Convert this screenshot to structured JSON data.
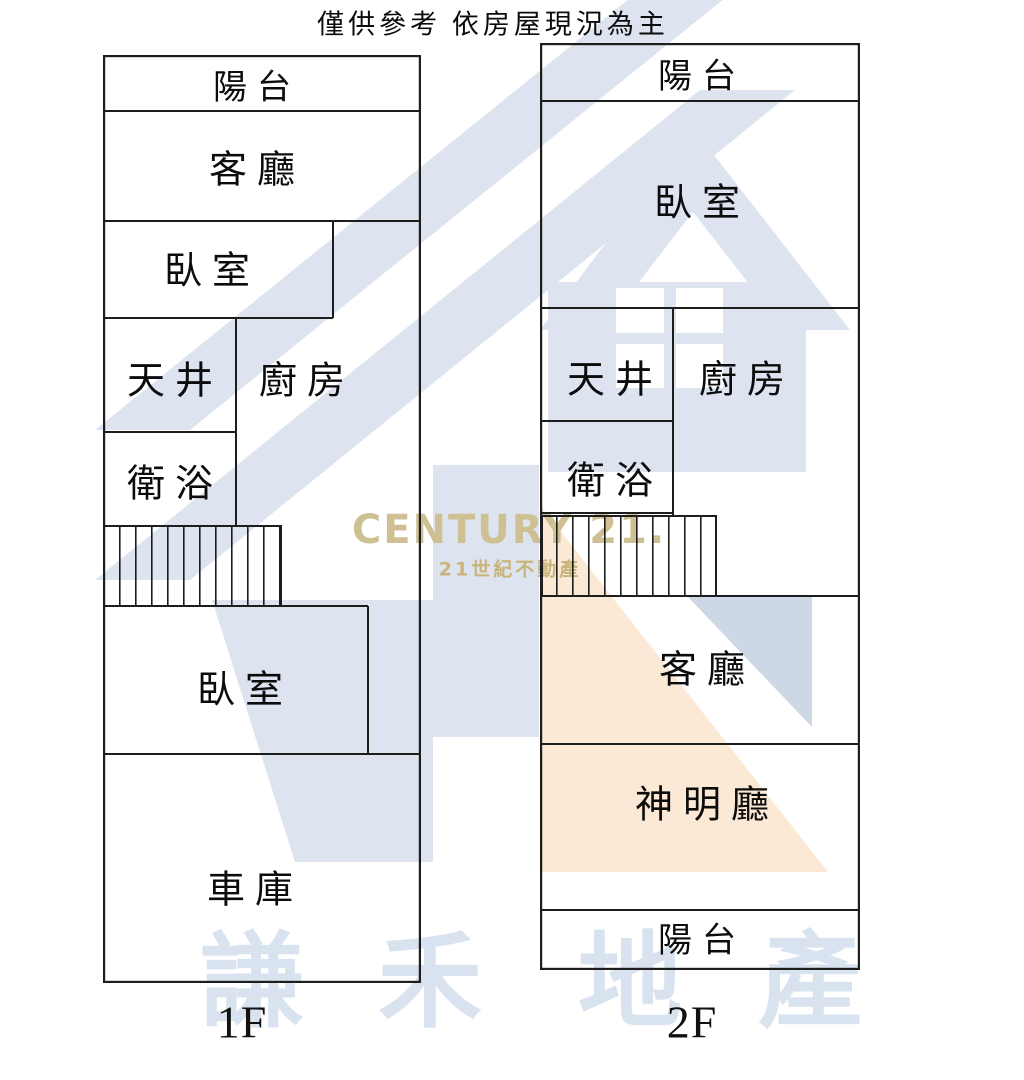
{
  "title": "僅供參考 依房屋現況為主",
  "floor1": {
    "label": "1F",
    "rooms": {
      "balcony": "陽台",
      "living_room": "客廳",
      "bedroom_front": "臥室",
      "light_well": "天井",
      "kitchen": "廚房",
      "bathroom": "衛浴",
      "bedroom_rear": "臥室",
      "garage": "車庫"
    }
  },
  "floor2": {
    "label": "2F",
    "rooms": {
      "balcony_front": "陽台",
      "bedroom": "臥室",
      "light_well": "天井",
      "kitchen": "廚房",
      "bathroom": "衛浴",
      "living_room": "客廳",
      "shrine_room": "神明廳",
      "balcony_rear": "陽台"
    }
  },
  "watermark": {
    "brand": "CENTURY 21.",
    "brand_tagline": "21世紀不動產",
    "agency_name": "謙禾地產",
    "agency_chars": [
      "謙",
      "禾",
      "地",
      "產"
    ],
    "colors": {
      "pale_blue": "#dde4ef",
      "mid_blue": "#cdd7e5",
      "peach": "#fbe9d6",
      "gold": "#cfc094",
      "gold_dark": "#c9b57c",
      "agency_blue": "#d9e3f0",
      "line": "#1d1d1d"
    }
  }
}
